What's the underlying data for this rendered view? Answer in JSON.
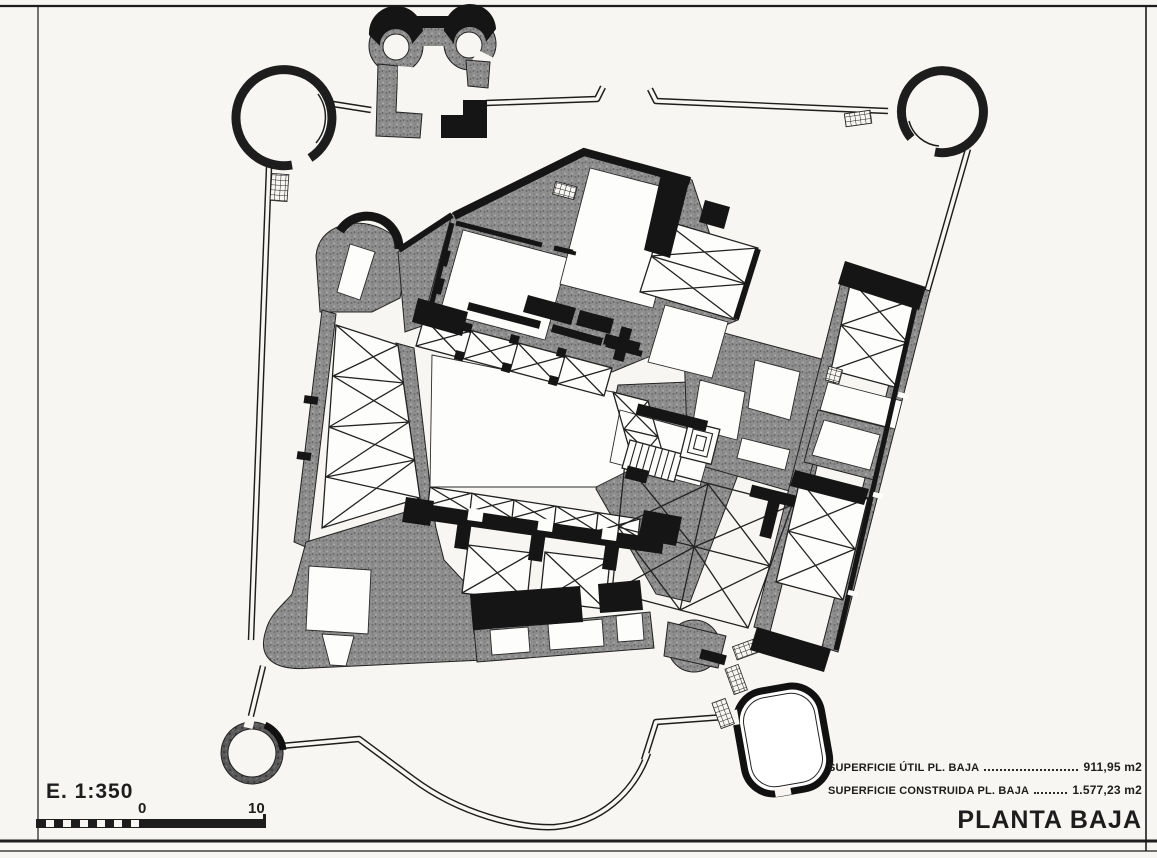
{
  "document": {
    "type": "scanned architectural floor plan",
    "drawing_title": "PLANTA BAJA"
  },
  "colors": {
    "paper": "#f7f6f2",
    "ink": "#1d1d1d",
    "wall_gray": "#8e8e8e",
    "wall_gray_dark": "#5a5a5a"
  },
  "scale_block": {
    "scale_label": "E. 1:350",
    "tick_start": "0",
    "tick_end": "10"
  },
  "title_block": {
    "rows": [
      {
        "label": "SUPERFICIE ÚTIL PL. BAJA",
        "value": "911,95 m2"
      },
      {
        "label": "SUPERFICIE CONSTRUIDA PL. BAJA",
        "value": "1.577,23 m2"
      }
    ],
    "title": "PLANTA BAJA"
  },
  "plan_elements": {
    "towers": [
      "nw-round-tower",
      "ne-round-tower",
      "sw-round-tower",
      "se-oval-tower"
    ],
    "gatehouse": "twin-lobed-gate",
    "wings": [
      "west-gallery",
      "north-range",
      "east-range",
      "south-range",
      "right-wing"
    ],
    "courtyard": "central-courtyard",
    "stairs": [
      "straight-stair",
      "spiral-stair",
      "entry-steps"
    ]
  }
}
